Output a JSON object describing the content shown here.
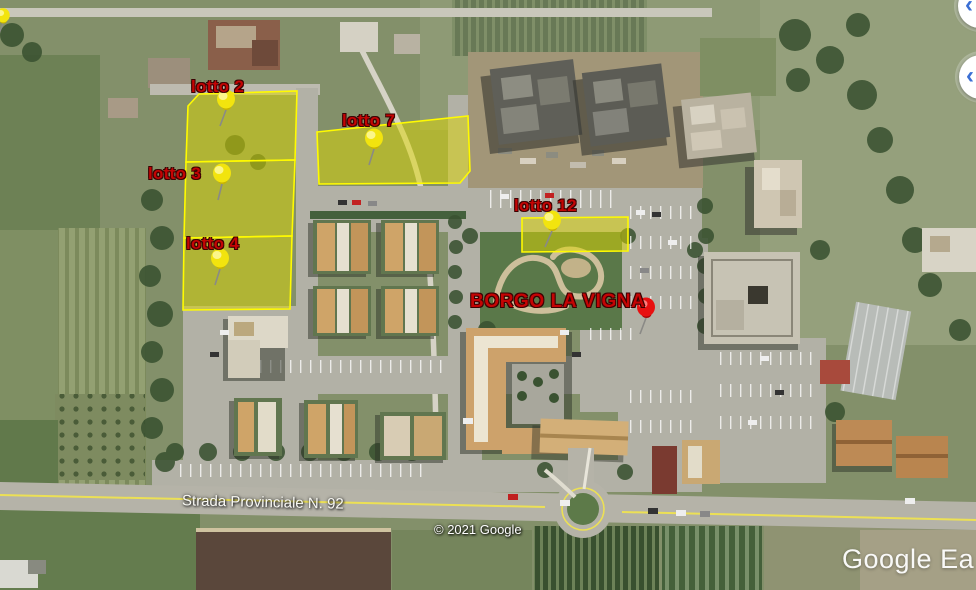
{
  "annotations": {
    "label_color": "#c40404",
    "lot_fill": "#ded800",
    "lot_border": "#fffb00",
    "pin_yellow": "#f2e40e",
    "pin_red": "#e81010",
    "lots": [
      {
        "label": "lotto 2"
      },
      {
        "label": "lotto 3"
      },
      {
        "label": "lotto 4"
      },
      {
        "label": "lotto 7"
      },
      {
        "label": "lotto 12"
      }
    ],
    "place_label": "BORGO LA VIGNA"
  },
  "map": {
    "road_label": "Strada Provinciale N. 92",
    "attribution": "© 2021 Google",
    "watermark": "Google Ea"
  },
  "controls": {
    "arrow_color": "#3b6fd4",
    "nav_arrows": [
      {
        "glyph": "‹"
      },
      {
        "glyph": "‹"
      }
    ]
  }
}
